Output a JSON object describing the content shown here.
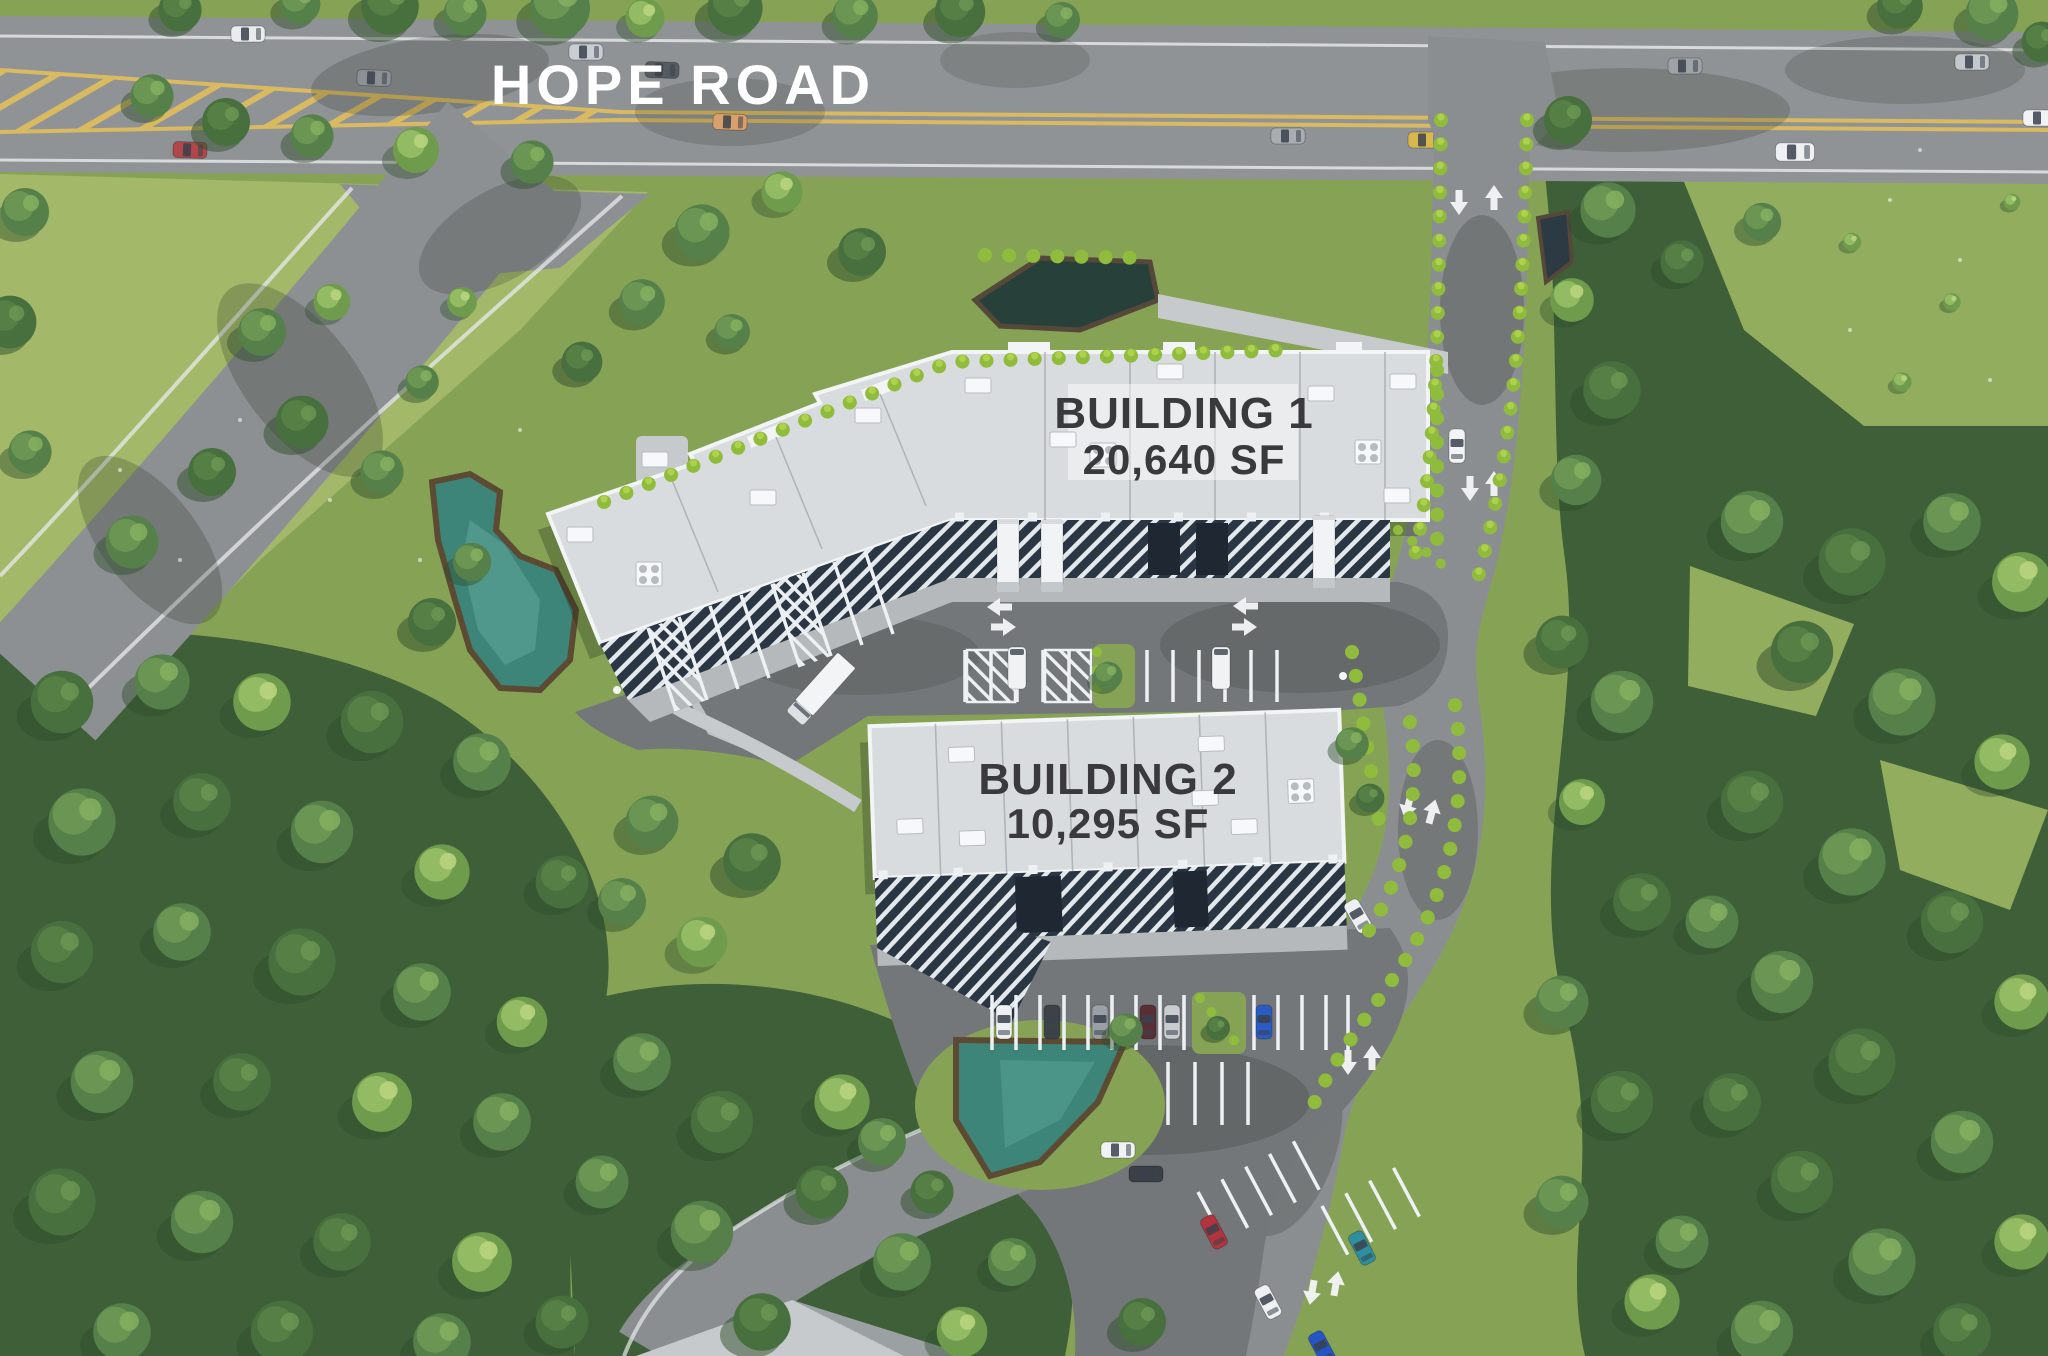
{
  "road": {
    "label": "HOPE ROAD"
  },
  "building1": {
    "name": "BUILDING 1",
    "area": "20,640 SF"
  },
  "building2": {
    "name": "BUILDING 2",
    "area": "10,295 SF"
  },
  "colors": {
    "grass": "#86a355",
    "field": "#a3b869",
    "clearing": "#93ad5f",
    "forest": "#3f5f38",
    "treeDark": "#2f4d2c",
    "shrub": "#8fbc3c",
    "road": "#909396",
    "drive": "#8b8e91",
    "court": "#74777a",
    "concrete": "#c6cacc",
    "roof": "#d9dcde",
    "roofEdge": "#f2f4f5",
    "canopy": "#2b3645",
    "stripe": "#e2e8ec",
    "pond": "#3e8579",
    "pondDark": "#27413a",
    "earth": "#6b5236",
    "yellow": "#d9ba60",
    "textDark": "#3a3a3c",
    "white": "#ffffff",
    "shadow": "rgba(22,32,18,0.28)"
  }
}
